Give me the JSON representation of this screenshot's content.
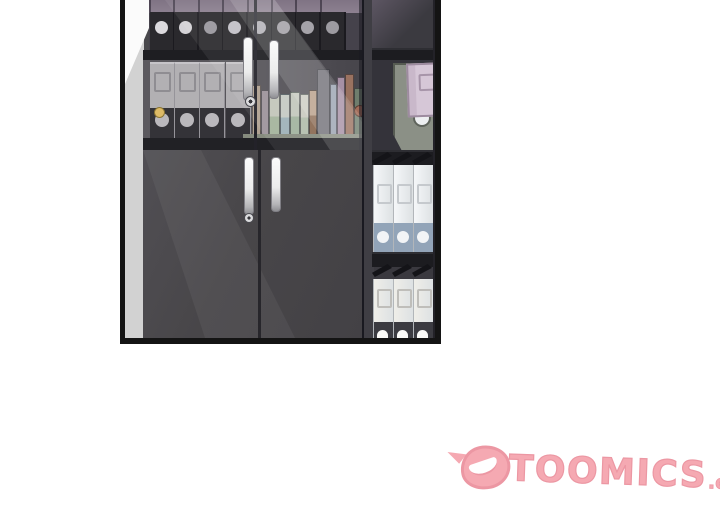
{
  "watermark": {
    "brand": "TOOMICS",
    "suffix": ".com",
    "fill_color": "#f5a9b2",
    "outline_color": "#ec97a3",
    "mark_icon": "toomics-smile-d-logo"
  },
  "panel": {
    "border_color": "#141414",
    "background": "#49484c",
    "wall_color": "#d2d2d2",
    "light_color": "#ffffff"
  },
  "cabinet": {
    "frame_color": "#1e1e22",
    "door_color": "#484649",
    "handle_color": "#f1f1f1",
    "keyhole_color": "#dbdbdd",
    "top_shelf": {
      "back_color": "#8d8090",
      "binder_color": "#2a292d",
      "binder_count": 8,
      "hole_shades": [
        "#dcdade",
        "#d4d2d6",
        "#98969c",
        "#c2c0c6",
        "#aeacb2",
        "#9b99a0",
        "#a5a3a9",
        "#9d9ba1"
      ]
    },
    "middle_shelf": {
      "back_color": "#555359",
      "gray_binders": {
        "count": 4,
        "body": "#b2b0b3",
        "label_edge": "#8f8d92",
        "band": "#343338",
        "hole": "#bab8bc"
      },
      "left_knob_color": "#ddba66",
      "right_knob_color": "#a26c59",
      "shelf_top_color": "#868b7e",
      "books": [
        {
          "x": 127,
          "w": 9,
          "h": 52,
          "c": "#b0a191"
        },
        {
          "x": 136,
          "w": 8,
          "h": 47,
          "c": "#9c939a"
        },
        {
          "x": 144,
          "w": 11,
          "h": 45,
          "c": "#c2c5ba",
          "c2": "#a3b39b"
        },
        {
          "x": 155,
          "w": 10,
          "h": 43,
          "c": "#c5cac3",
          "c2": "#9eb1b7"
        },
        {
          "x": 165,
          "w": 10,
          "h": 45,
          "c": "#c3c8bd",
          "c2": "#a2b39f"
        },
        {
          "x": 175,
          "w": 9,
          "h": 43,
          "c": "#cbcbc1",
          "c2": "#b3bead"
        },
        {
          "x": 184,
          "w": 8,
          "h": 47,
          "c": "#b79e86",
          "c2": "#8a6a52"
        },
        {
          "x": 192,
          "w": 13,
          "h": 68,
          "c": "#706f76"
        },
        {
          "x": 205,
          "w": 7,
          "h": 53,
          "c": "#99a2b0"
        },
        {
          "x": 212,
          "w": 8,
          "h": 60,
          "c": "#a690a5"
        },
        {
          "x": 220,
          "w": 9,
          "h": 63,
          "c": "#9a7260"
        },
        {
          "x": 229,
          "w": 9,
          "h": 49,
          "c": "#6f7d6d"
        }
      ]
    },
    "right_unit": {
      "post_color": "#3f3e44",
      "compartment_color": "#34333a",
      "frame_color": "#1c1c20",
      "lavender_binder": {
        "body": "#c9b8ca",
        "face": "#d6c7d7",
        "edge": "#9d8b9f"
      },
      "file_box": {
        "body": "#8b9086",
        "hole": "#edeff1"
      },
      "upper_binders": {
        "count": 3,
        "body": "#f5f7f9",
        "band": "#92a4b8",
        "label_edge": "#c5c9cd",
        "flap": "#141418",
        "hole": "#f2f4f6"
      },
      "lower_binders": {
        "count": 3,
        "body": "#efeee9",
        "band": "#3b3b41",
        "label_edge": "#bfbeba",
        "flap": "#141418",
        "hole": "#fafaf8"
      }
    }
  }
}
